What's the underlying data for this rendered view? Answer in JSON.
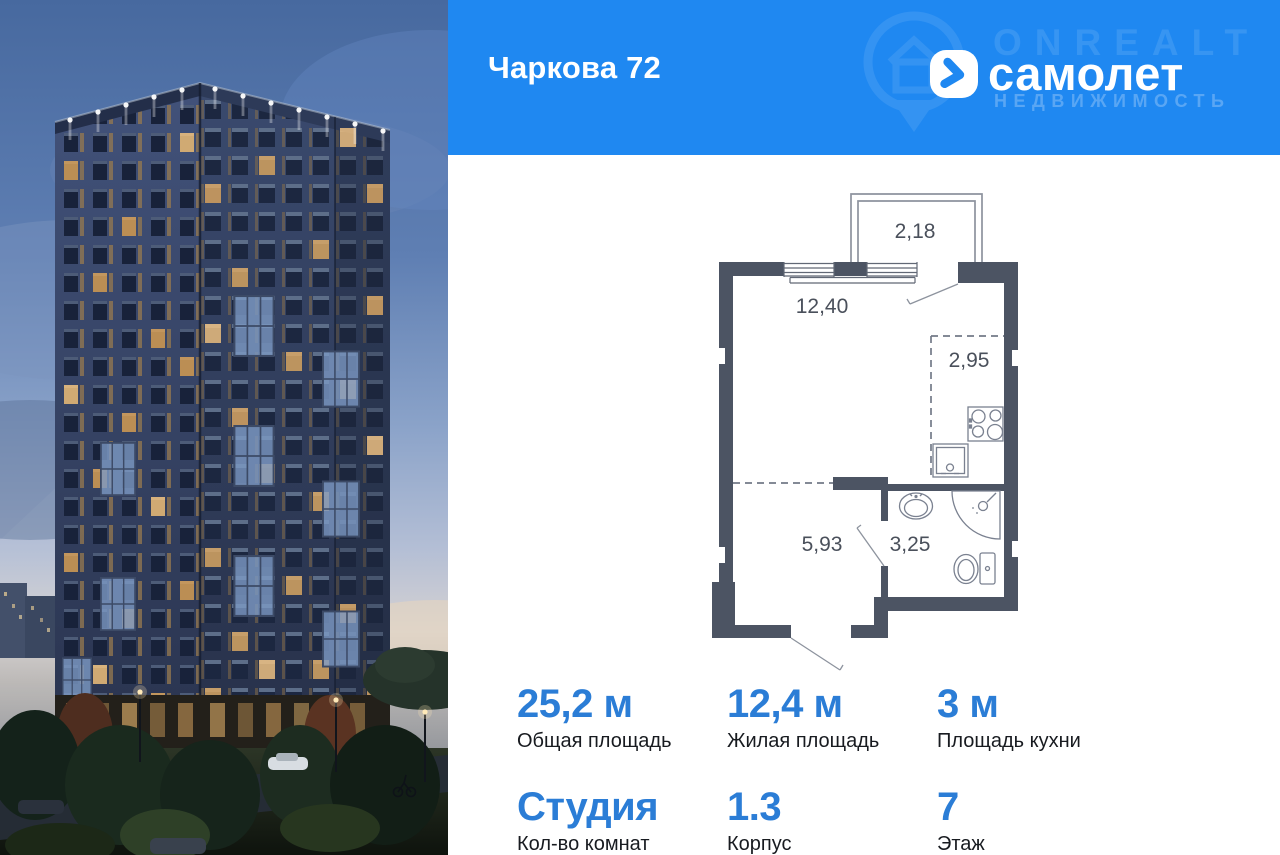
{
  "header": {
    "title": "Чаркова 72",
    "brand": "самолет",
    "watermark_line1": "ONREALT",
    "watermark_line2": "НЕДВИЖИМОСТЬ"
  },
  "floor_plan": {
    "balcony_area": "2,18",
    "living_area": "12,40",
    "kitchen_area": "2,95",
    "hallway_area": "5,93",
    "bathroom_area": "3,25"
  },
  "stats": [
    {
      "value": "25,2 м",
      "label": "Общая площадь"
    },
    {
      "value": "12,4 м",
      "label": "Жилая площадь"
    },
    {
      "value": "3 м",
      "label": "Площадь кухни"
    },
    {
      "value": "Студия",
      "label": "Кол-во комнат"
    },
    {
      "value": "1.3",
      "label": "Корпус"
    },
    {
      "value": "7",
      "label": "Этаж"
    }
  ],
  "colors": {
    "banner_blue": "#1f88f1",
    "stat_blue": "#2b7dd6",
    "wall": "#4c5463"
  }
}
